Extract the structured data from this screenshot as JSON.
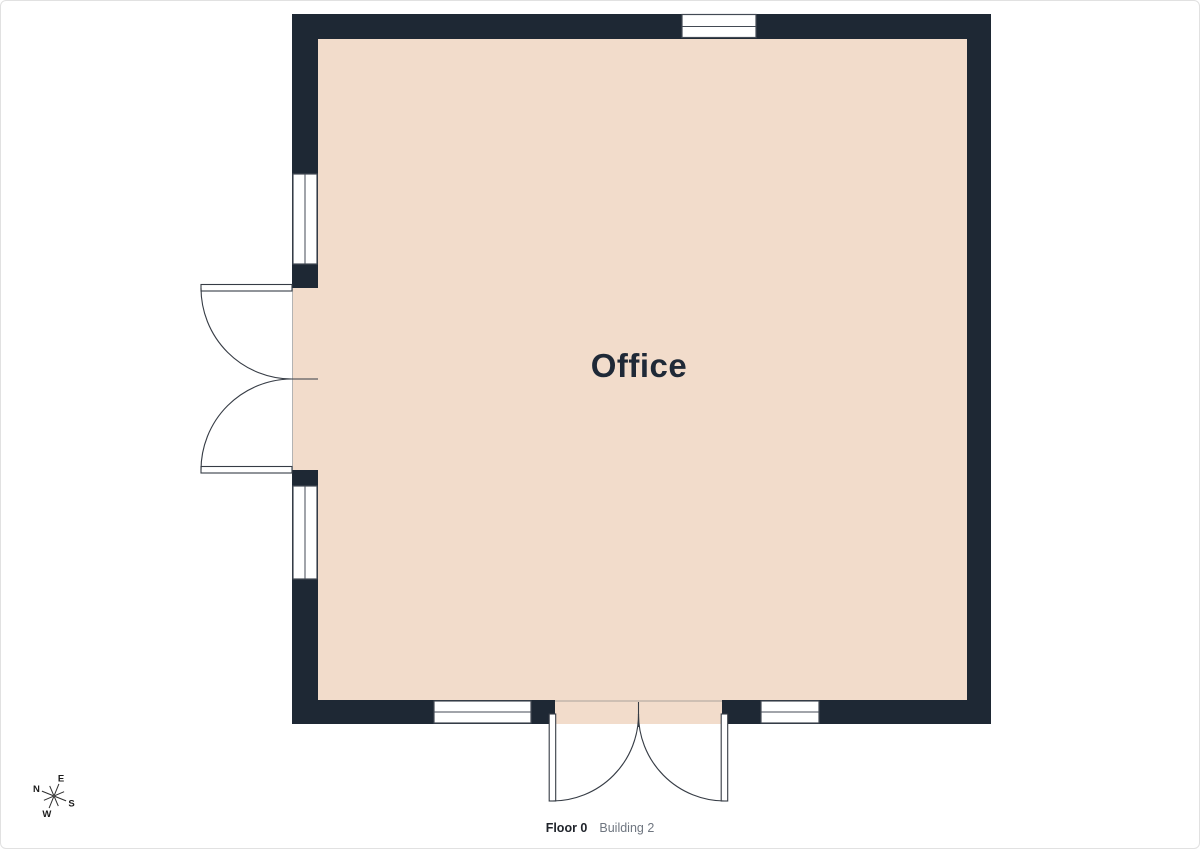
{
  "floorplan": {
    "room_label": "Office"
  },
  "footer": {
    "floor": "Floor 0",
    "building": "Building 2"
  },
  "compass": {
    "north": "N",
    "east": "E",
    "south": "S",
    "west": "W"
  },
  "colors": {
    "floor": "#f2dccb",
    "wall": "#1e2834",
    "frame_line": "#434a54",
    "label": "#1f2937"
  }
}
